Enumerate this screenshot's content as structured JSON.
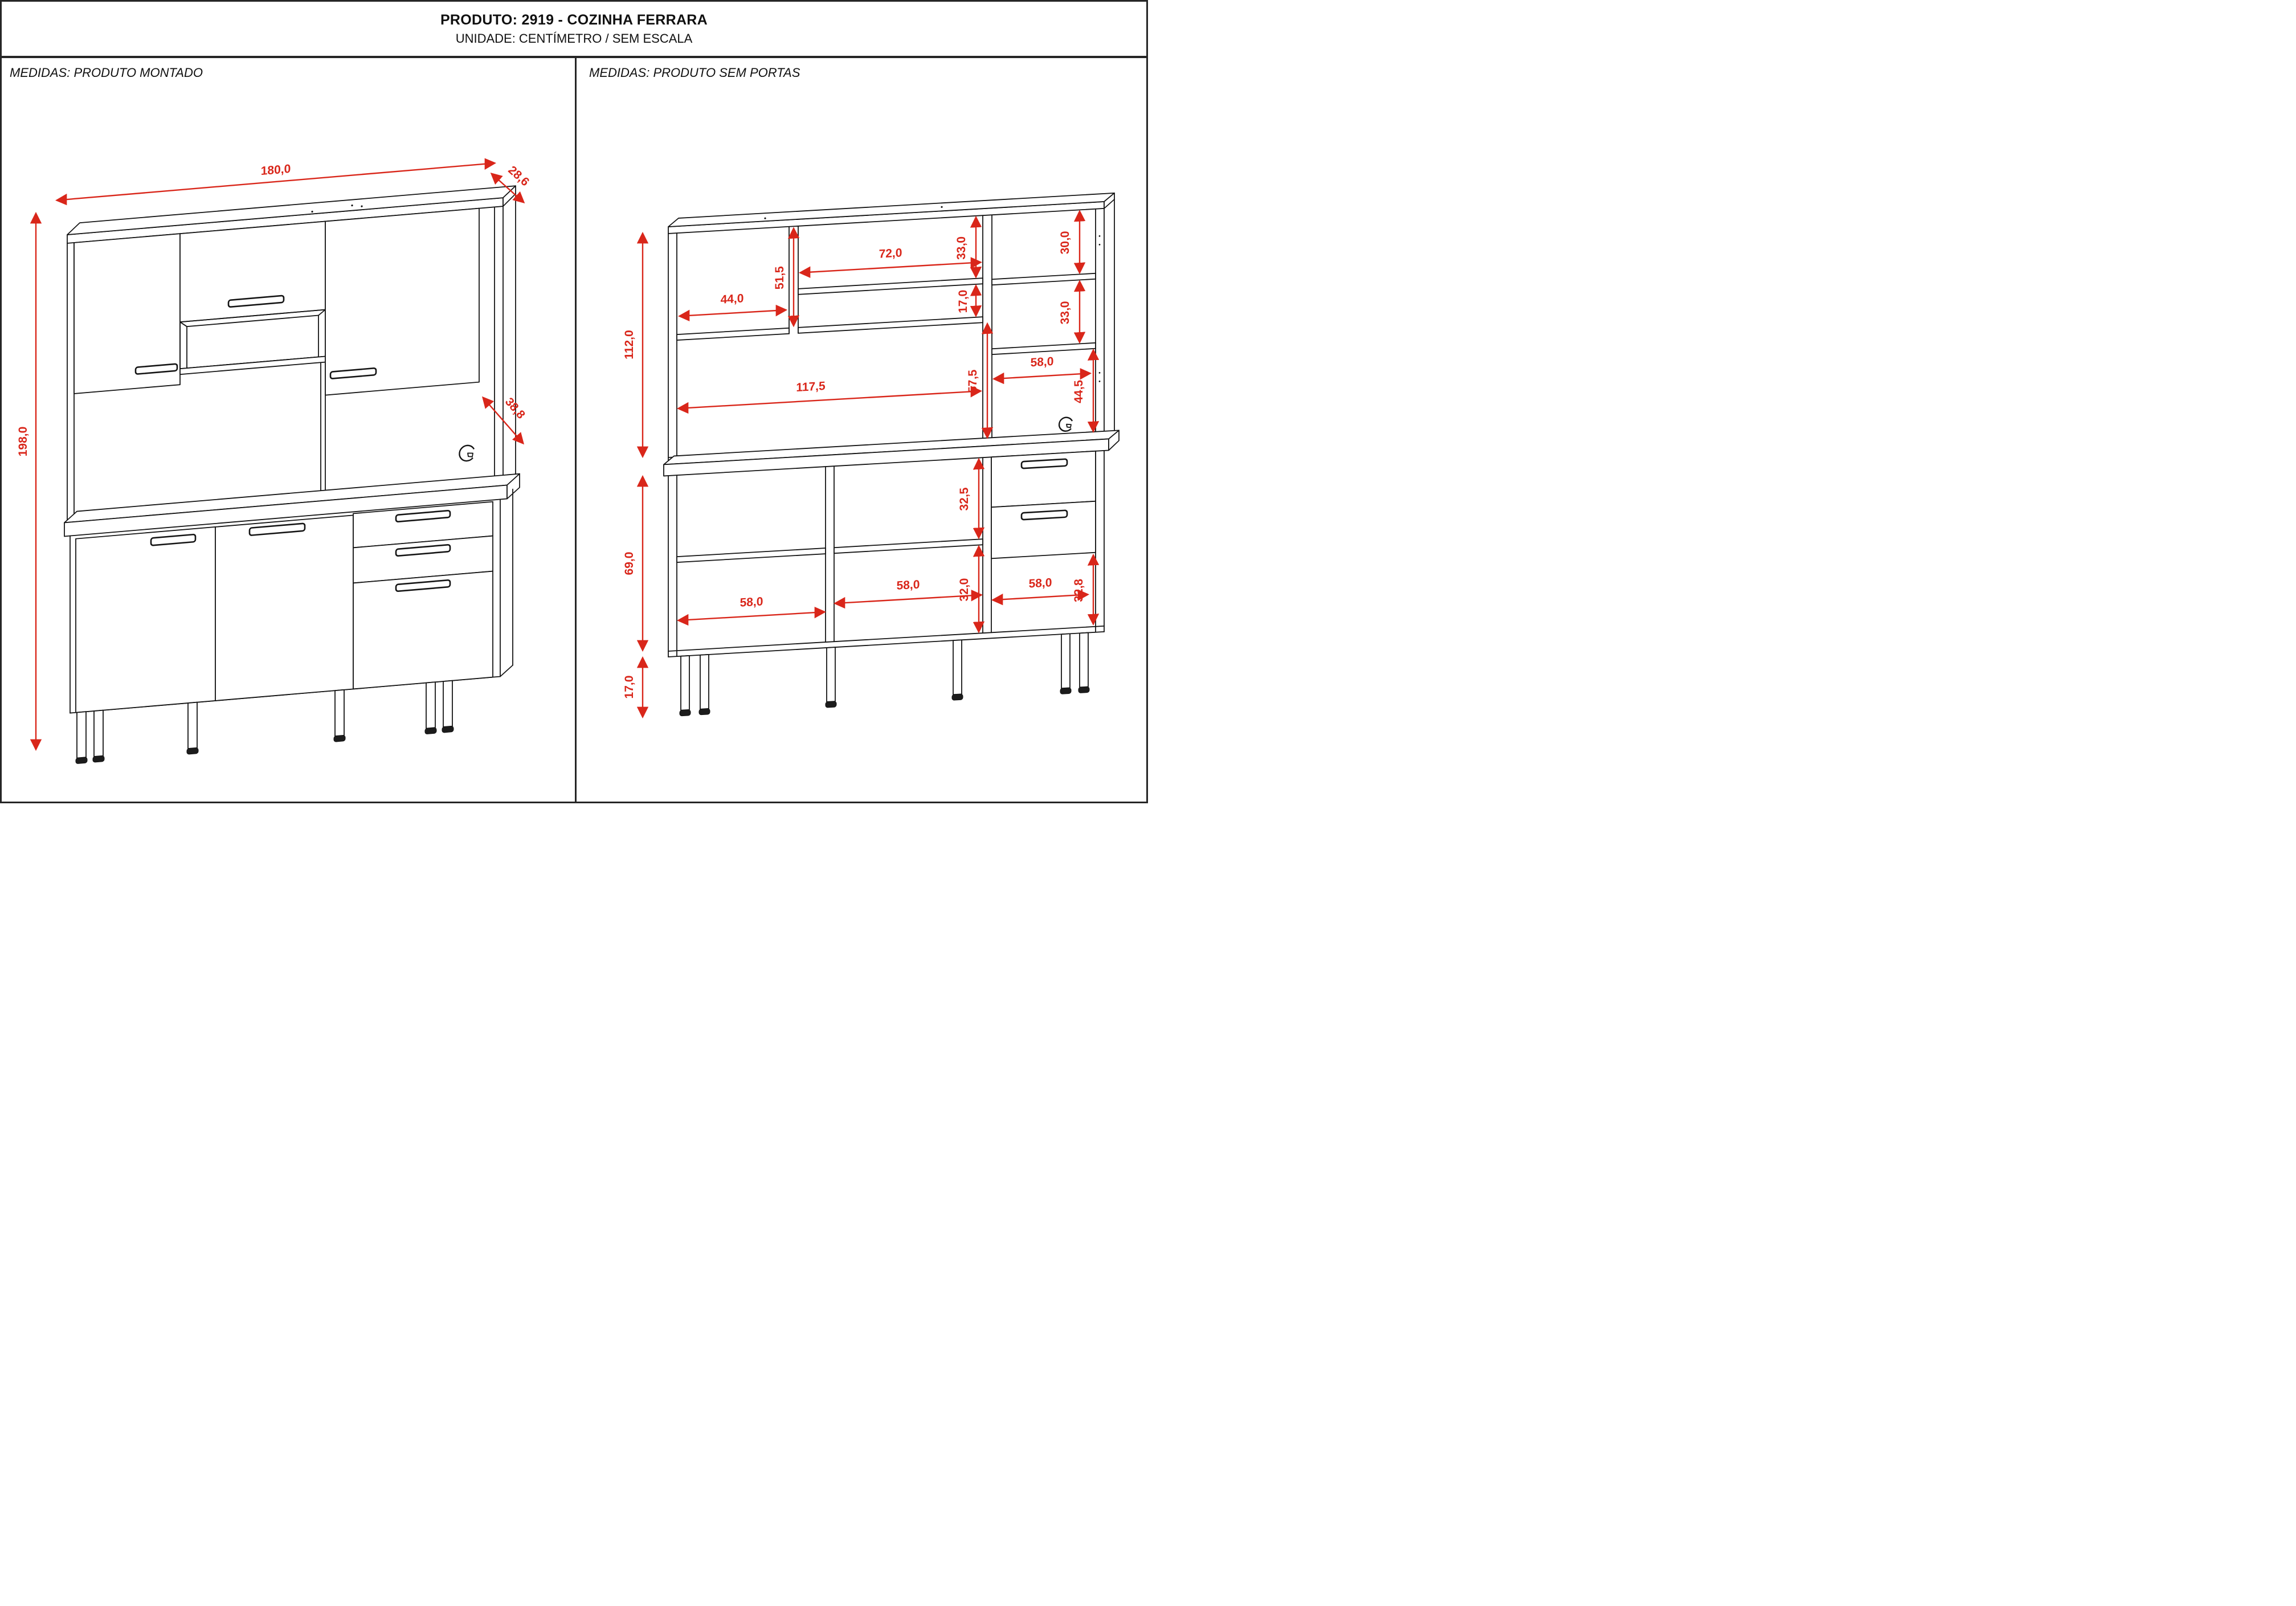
{
  "title": {
    "product": "PRODUTO: 2919 - COZINHA FERRARA",
    "unit": "UNIDADE: CENTÍMETRO / SEM ESCALA"
  },
  "left_panel": {
    "header": "MEDIDAS: PRODUTO MONTADO",
    "dims": {
      "width": "180,0",
      "top_depth": "28,6",
      "height": "198,0",
      "base_depth": "38,8"
    }
  },
  "right_panel": {
    "header": "MEDIDAS: PRODUTO SEM PORTAS",
    "dims": {
      "hutch_height": "112,0",
      "left_compartment_width": "44,0",
      "left_compartment_height": "51,5",
      "middle_width": "72,0",
      "middle_top_height": "33,0",
      "middle_gap_height": "17,0",
      "right_top_height": "30,0",
      "right_middle_height": "33,0",
      "center_open_height": "57,5",
      "center_open_width": "117,5",
      "hutch_right_open_width": "58,0",
      "hutch_right_open_height": "44,5",
      "base_height": "69,0",
      "base_upper_height": "32,5",
      "base_lower_height": "32,0",
      "base_left_width": "58,0",
      "base_middle_width": "58,0",
      "base_right_width": "58,0",
      "base_right_open_height": "32,8",
      "leg_height": "17,0"
    }
  },
  "colors": {
    "dimension_red": "#d9261a",
    "line_black": "#141414"
  }
}
